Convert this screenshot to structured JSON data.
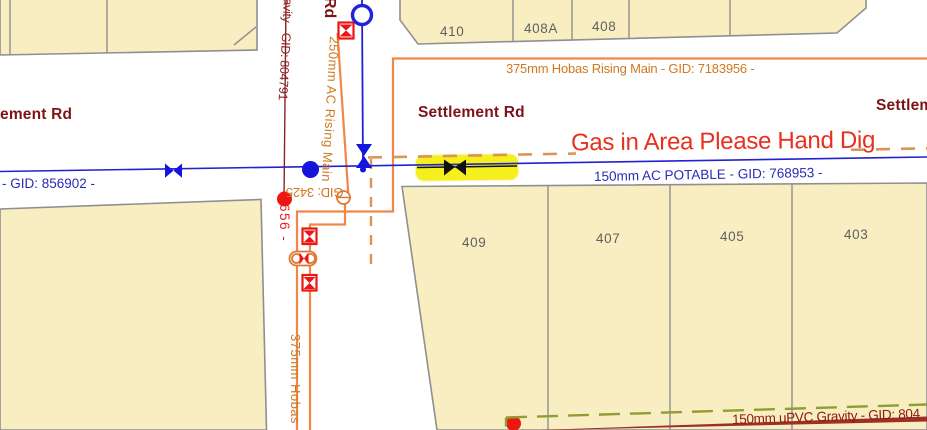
{
  "map": {
    "streets": {
      "left_partial": "ement Rd",
      "center": "Settlement Rd",
      "right": "Settlement Rd",
      "top_vertical_partial": "Rd"
    },
    "warning": {
      "gas_text": "Gas in Area Please Hand Dig",
      "color": "#e8301e"
    },
    "pipes": {
      "hobas_rising_main_label": "375mm Hobas Rising Main - GID: 7183956 -",
      "hobas_vertical_label": "375mm Hobas",
      "ac_rising_main_label": "250mm AC Rising Main",
      "potable_main_label": "150mm AC POTABLE - GID: 768953 -",
      "potable_gid_left_label": "- GID: 856902 -",
      "gravity_main_vertical_label": "avity - GID: 804791",
      "gid_656_label": "656 -",
      "gid_3425_label": "GID: 3425",
      "upvc_gravity_label": "150mm uPVC Gravity - GID: 804"
    },
    "parcels": {
      "top_right_row": [
        "410",
        "408A",
        "408"
      ],
      "middle_row": [
        "409",
        "407",
        "405",
        "403"
      ]
    },
    "colors": {
      "parcel_fill": "#f9eec2",
      "parcel_border": "#8f8f8f",
      "potable_blue": "#2222d0",
      "pipe_orange": "#f08748",
      "gas_dash_orange": "#dc9455",
      "valve_red": "#ee1512",
      "street_maroon": "#7c1417",
      "gravity_olive": "#8f9e33",
      "sewer_maroon": "#9c2f26",
      "highlight_yellow": "#f4ef1d"
    }
  }
}
